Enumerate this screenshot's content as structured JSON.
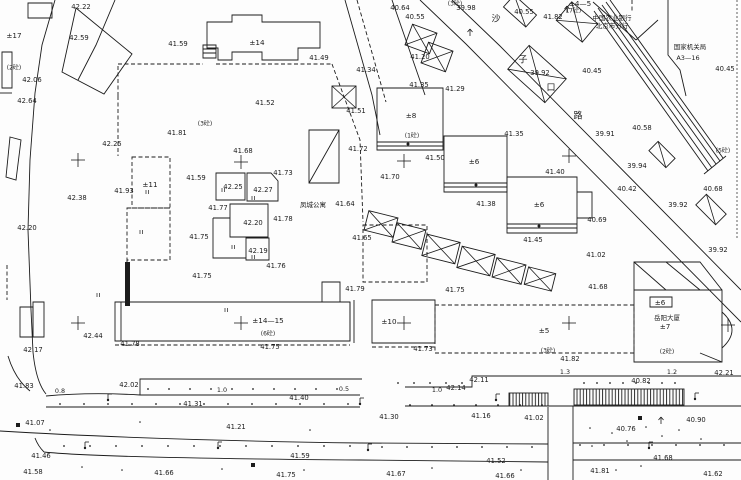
{
  "drawing": {
    "width": 741,
    "height": 480,
    "background": "#fdfdfd",
    "ink": "#1c1c1c",
    "type": "cadastral-site-plan"
  },
  "labels": {
    "elevations": [
      {
        "v": "42.22",
        "x": 81,
        "y": 7
      },
      {
        "v": "42.59",
        "x": 79,
        "y": 38
      },
      {
        "v": "42.06",
        "x": 32,
        "y": 80
      },
      {
        "v": "42.64",
        "x": 27,
        "y": 101
      },
      {
        "v": "41.59",
        "x": 178,
        "y": 44
      },
      {
        "v": "40.64",
        "x": 400,
        "y": 8
      },
      {
        "v": "40.55",
        "x": 415,
        "y": 17
      },
      {
        "v": "39.98",
        "x": 466,
        "y": 8
      },
      {
        "v": "40.55",
        "x": 524,
        "y": 12
      },
      {
        "v": "41.82",
        "x": 553,
        "y": 17
      },
      {
        "v": "39.92",
        "x": 540,
        "y": 73
      },
      {
        "v": "40.45",
        "x": 592,
        "y": 71,
        "fs": 8.5
      },
      {
        "v": "40.45",
        "x": 725,
        "y": 69
      },
      {
        "v": "41.49",
        "x": 319,
        "y": 58,
        "fs": 7.5
      },
      {
        "v": "41.34",
        "x": 366,
        "y": 70
      },
      {
        "v": "41.52",
        "x": 265,
        "y": 103
      },
      {
        "v": "41.51",
        "x": 356,
        "y": 111
      },
      {
        "v": "41.20",
        "x": 420,
        "y": 57
      },
      {
        "v": "41.35",
        "x": 419,
        "y": 85
      },
      {
        "v": "41.29",
        "x": 455,
        "y": 89
      },
      {
        "v": "40.58",
        "x": 642,
        "y": 128,
        "fs": 8
      },
      {
        "v": "39.91",
        "x": 605,
        "y": 134
      },
      {
        "v": "39.94",
        "x": 637,
        "y": 166,
        "fs": 7.5
      },
      {
        "v": "40.42",
        "x": 627,
        "y": 189,
        "fs": 7.5
      },
      {
        "v": "40.68",
        "x": 713,
        "y": 189,
        "fs": 8
      },
      {
        "v": "39.92",
        "x": 678,
        "y": 205
      },
      {
        "v": "39.92",
        "x": 718,
        "y": 250
      },
      {
        "v": "40.69",
        "x": 597,
        "y": 220
      },
      {
        "v": "42.25",
        "x": 112,
        "y": 144
      },
      {
        "v": "41.81",
        "x": 177,
        "y": 133
      },
      {
        "v": "42.38",
        "x": 77,
        "y": 198,
        "fs": 8
      },
      {
        "v": "41.93",
        "x": 124,
        "y": 191
      },
      {
        "v": "42.20",
        "x": 27,
        "y": 228
      },
      {
        "v": "41.59",
        "x": 196,
        "y": 178
      },
      {
        "v": "41.68",
        "x": 243,
        "y": 151
      },
      {
        "v": "41.73",
        "x": 283,
        "y": 173
      },
      {
        "v": "42.25",
        "x": 233,
        "y": 187
      },
      {
        "v": "42.27",
        "x": 263,
        "y": 190
      },
      {
        "v": "41.77",
        "x": 218,
        "y": 208
      },
      {
        "v": "42.20",
        "x": 253,
        "y": 223
      },
      {
        "v": "41.78",
        "x": 283,
        "y": 219
      },
      {
        "v": "41.75",
        "x": 199,
        "y": 237
      },
      {
        "v": "42.19",
        "x": 258,
        "y": 251
      },
      {
        "v": "41.76",
        "x": 276,
        "y": 266
      },
      {
        "v": "41.75",
        "x": 202,
        "y": 276
      },
      {
        "v": "41.72",
        "x": 358,
        "y": 149
      },
      {
        "v": "41.64",
        "x": 345,
        "y": 204
      },
      {
        "v": "41.65",
        "x": 362,
        "y": 238
      },
      {
        "v": "41.70",
        "x": 390,
        "y": 177
      },
      {
        "v": "41.50",
        "x": 435,
        "y": 158
      },
      {
        "v": "41.35",
        "x": 514,
        "y": 134
      },
      {
        "v": "41.40",
        "x": 555,
        "y": 172
      },
      {
        "v": "41.38",
        "x": 486,
        "y": 204
      },
      {
        "v": "41.45",
        "x": 533,
        "y": 240
      },
      {
        "v": "41.02",
        "x": 596,
        "y": 255
      },
      {
        "v": "41.68",
        "x": 598,
        "y": 287
      },
      {
        "v": "41.79",
        "x": 355,
        "y": 289
      },
      {
        "v": "41.75",
        "x": 455,
        "y": 290
      },
      {
        "v": "41.75",
        "x": 270,
        "y": 347
      },
      {
        "v": "41.73",
        "x": 423,
        "y": 349
      },
      {
        "v": "42.44",
        "x": 93,
        "y": 336
      },
      {
        "v": "42.17",
        "x": 33,
        "y": 350
      },
      {
        "v": "41.78",
        "x": 130,
        "y": 344
      },
      {
        "v": "41.82",
        "x": 570,
        "y": 359
      },
      {
        "v": "42.21",
        "x": 724,
        "y": 373
      },
      {
        "v": "41.83",
        "x": 24,
        "y": 386
      },
      {
        "v": "42.02",
        "x": 129,
        "y": 385
      },
      {
        "v": "41.31",
        "x": 193,
        "y": 404
      },
      {
        "v": "41.07",
        "x": 35,
        "y": 423
      },
      {
        "v": "41.21",
        "x": 236,
        "y": 427
      },
      {
        "v": "41.40",
        "x": 299,
        "y": 398
      },
      {
        "v": "42.14",
        "x": 456,
        "y": 388
      },
      {
        "v": "42.11",
        "x": 479,
        "y": 380
      },
      {
        "v": "41.30",
        "x": 389,
        "y": 417
      },
      {
        "v": "41.16",
        "x": 481,
        "y": 416
      },
      {
        "v": "40.82",
        "x": 641,
        "y": 381
      },
      {
        "v": "41.02",
        "x": 534,
        "y": 418
      },
      {
        "v": "40.90",
        "x": 696,
        "y": 420
      },
      {
        "v": "40.76",
        "x": 626,
        "y": 429
      },
      {
        "v": "41.46",
        "x": 41,
        "y": 456
      },
      {
        "v": "41.58",
        "x": 33,
        "y": 472
      },
      {
        "v": "41.59",
        "x": 300,
        "y": 456
      },
      {
        "v": "41.66",
        "x": 164,
        "y": 473
      },
      {
        "v": "41.75",
        "x": 286,
        "y": 475
      },
      {
        "v": "41.67",
        "x": 396,
        "y": 474
      },
      {
        "v": "41.52",
        "x": 496,
        "y": 461
      },
      {
        "v": "41.66",
        "x": 505,
        "y": 476
      },
      {
        "v": "41.68",
        "x": 663,
        "y": 458
      },
      {
        "v": "41.81",
        "x": 600,
        "y": 471
      },
      {
        "v": "41.62",
        "x": 713,
        "y": 474
      }
    ],
    "dimensions": [
      {
        "v": "0.8",
        "x": 60,
        "y": 391
      },
      {
        "v": "1.0",
        "x": 222,
        "y": 390
      },
      {
        "v": "0.5",
        "x": 344,
        "y": 389
      },
      {
        "v": "1.0",
        "x": 437,
        "y": 390
      },
      {
        "v": "1.3",
        "x": 565,
        "y": 372
      },
      {
        "v": "1.2",
        "x": 672,
        "y": 372
      }
    ],
    "buildings": [
      {
        "v": "±17",
        "x": 14,
        "y": 36
      },
      {
        "v": "±14",
        "x": 257,
        "y": 43
      },
      {
        "v": "±11",
        "x": 150,
        "y": 185
      },
      {
        "v": "±8",
        "x": 411,
        "y": 116
      },
      {
        "v": "±6",
        "x": 474,
        "y": 162
      },
      {
        "v": "±6",
        "x": 539,
        "y": 205
      },
      {
        "v": "±14—15",
        "x": 268,
        "y": 321
      },
      {
        "v": "±10",
        "x": 389,
        "y": 322
      },
      {
        "v": "±5",
        "x": 544,
        "y": 331
      },
      {
        "v": "±6",
        "x": 660,
        "y": 303
      },
      {
        "v": "±7",
        "x": 665,
        "y": 327
      },
      {
        "v": "±4—5",
        "x": 580,
        "y": 4
      }
    ],
    "materials": [
      {
        "v": "(2砼)",
        "x": 14,
        "y": 68
      },
      {
        "v": "(3砼)",
        "x": 205,
        "y": 124
      },
      {
        "v": "(3砼)",
        "x": 455,
        "y": 4
      },
      {
        "v": "(7砼)",
        "x": 574,
        "y": 11
      },
      {
        "v": "(1砼)",
        "x": 412,
        "y": 136
      },
      {
        "v": "(5砼)",
        "x": 723,
        "y": 151
      },
      {
        "v": "(6砼)",
        "x": 268,
        "y": 334
      },
      {
        "v": "(3砼)",
        "x": 548,
        "y": 351
      },
      {
        "v": "(2砼)",
        "x": 667,
        "y": 352
      }
    ],
    "names": [
      {
        "v": "凤城公寓",
        "x": 313,
        "y": 205
      },
      {
        "v": "中国农业银行",
        "x": 612,
        "y": 18
      },
      {
        "v": "北京市分行",
        "x": 612,
        "y": 26
      },
      {
        "v": "国家机关局",
        "x": 690,
        "y": 47
      },
      {
        "v": "A3—16",
        "x": 688,
        "y": 58
      },
      {
        "v": "岳阳大厦",
        "x": 667,
        "y": 318
      }
    ],
    "street": {
      "chars": [
        "沙",
        "子",
        "口",
        "路"
      ],
      "pos": [
        [
          496,
          19
        ],
        [
          523,
          60
        ],
        [
          551,
          88
        ],
        [
          578,
          116
        ]
      ]
    }
  },
  "geometry": {
    "paths": [
      {
        "d": "M28,3 H52 V18 H28 Z",
        "s": "solid"
      },
      {
        "d": "M55,0 L42,45 L35,93 L30,160 L28,230 L31,310 L33,352",
        "s": "solid"
      },
      {
        "d": "M33,352 Q36,382 46,394",
        "s": "solid"
      },
      {
        "d": "M8,356 Q15,379 30,391",
        "s": "solid"
      },
      {
        "d": "M76,8 L132,54 L104,94 L62,72 Z",
        "s": "solid"
      },
      {
        "d": "M115,0 L96,45 L78,80",
        "s": "solid"
      },
      {
        "d": "M2,52 H12 V88 H2 Z",
        "s": "solid"
      },
      {
        "d": "M10,137 L21,140 L16,180 L6,177 Z",
        "s": "solid"
      },
      {
        "d": "M20,307 H33 V337 H20 Z",
        "s": "solid"
      },
      {
        "d": "M33,302 H44 V337 H33 Z",
        "s": "solid"
      },
      {
        "d": "M207,48 V22 H232 V15 H262 V22 H320 V48 H298 V60 H262 V52 H232 V60 H218 V48 Z",
        "s": "solid"
      },
      {
        "d": "M203,45 H216 V58 H203 Z M203,49 H216 M203,53 H216",
        "s": "solid"
      },
      {
        "d": "M309,130 H339 V183 H309 Z M309,183 L339,130",
        "s": "solid"
      },
      {
        "d": "M216,173 H245 V200 H216 Z",
        "s": "solid"
      },
      {
        "d": "M247,173 H271 L278,181 V201 H247 Z",
        "s": "solid"
      },
      {
        "d": "M230,204 H268 V237 H230 Z",
        "s": "solid"
      },
      {
        "d": "M246,238 H269 V260 H246 Z",
        "s": "solid"
      },
      {
        "d": "M213,218 V258 H246 M213,218 H230",
        "s": "solid"
      },
      {
        "d": "M377,88 H443 V150 H377 Z M377,142 H443 M377,146 H443",
        "s": "solid"
      },
      {
        "d": "M444,136 H507 V192 H444 Z M444,183 H507 M444,187 H507",
        "s": "solid"
      },
      {
        "d": "M507,177 H577 V233 H507 Z M507,224 H577 M507,228 H577 M577,192 H592 V218 H577",
        "s": "solid"
      },
      {
        "d": "M115,302 H350 V341 H115 Z M322,302 V282 H340 V302 M121,302 V341",
        "s": "solid"
      },
      {
        "d": "M350,302 V341 M354,300 V343",
        "s": "solid"
      },
      {
        "d": "M372,300 H435 V343 H372 Z",
        "s": "solid"
      },
      {
        "d": "M634,290 H722 V362 H634 Z M634,290 V262 H700 L722,290 M634,262 L666,290 M666,262 L700,290 M722,312 Q742,330 722,348 M700,353 L722,362 M650,297 H672 V307 H650 Z",
        "s": "solid"
      },
      {
        "d": "M420,0 L466,44 L741,322",
        "s": "solid"
      },
      {
        "d": "M452,0 L500,46 L741,290",
        "s": "solid"
      },
      {
        "d": "M598,8 L712,168 M602,5 L716,164 M606,2 L720,161 M610,0 L723,158 M594,11 L708,171 M704,174 L726,156",
        "s": "solid"
      },
      {
        "d": "M668,0 V55 L680,70 L686,96",
        "s": "solid"
      },
      {
        "d": "M593,2 L636,40 M636,40 L658,20",
        "s": "solid"
      },
      {
        "d": "M345,0 L372,95 L380,135 M392,0 L425,95",
        "s": "solid"
      },
      {
        "d": "M357,0 L386,102",
        "s": "dash"
      },
      {
        "d": "M46,396 Q90,392 140,395 M140,395 V379 H362 M140,395 H360",
        "s": "solid"
      },
      {
        "d": "M405,387 H472 V376 H741",
        "s": "solid"
      },
      {
        "d": "M46,407 H360 M405,406 H741",
        "s": "solid"
      },
      {
        "d": "M0,431 Q150,440 360,443 L548,444 M573,443 H741",
        "s": "solid"
      },
      {
        "d": "M44,452 Q100,458 360,460 L548,462 M573,460 H741 M44,452 Q38,446 35,438",
        "s": "solid"
      },
      {
        "d": "M548,407 V480 M573,406 V480",
        "s": "solid"
      },
      {
        "d": "M737,0 V238",
        "s": "dashfine"
      },
      {
        "d": "M7,265 V300",
        "s": "dash"
      },
      {
        "d": "M118,96 V64 M118,64 H203 M216,64 H332",
        "s": "dash"
      },
      {
        "d": "M332,64 L360,140 L363,222",
        "s": "dash"
      },
      {
        "d": "M363,225 H427 V282 H363 Z",
        "s": "dash"
      },
      {
        "d": "M118,96 V156",
        "s": "dash"
      },
      {
        "d": "M132,157 H170 V208 H132 Z",
        "s": "dash"
      },
      {
        "d": "M127,208 H170 V260 H127 Z",
        "s": "dash"
      },
      {
        "d": "M127,260 V302",
        "s": "dash"
      },
      {
        "d": "M115,345 H350 M372,347 H435",
        "s": "dash"
      },
      {
        "d": "M435,305 H634 V353 H435 Z",
        "s": "dash"
      },
      {
        "d": "M632,0 V12",
        "s": "dash"
      },
      {
        "d": "M0,93 L12,93",
        "s": "solid"
      }
    ],
    "crosses": [
      [
        78,
        160
      ],
      [
        241,
        162
      ],
      [
        404,
        161
      ],
      [
        569,
        156
      ],
      [
        78,
        323
      ],
      [
        241,
        323
      ],
      [
        404,
        323
      ],
      [
        569,
        323
      ],
      [
        728,
        325
      ]
    ],
    "crossed_boxes": [
      {
        "x": 408,
        "y": 28,
        "w": 26,
        "h": 22,
        "a": 20,
        "dg": 2
      },
      {
        "x": 424,
        "y": 46,
        "w": 26,
        "h": 22,
        "a": 20,
        "dg": 2
      },
      {
        "x": 332,
        "y": 86,
        "w": 24,
        "h": 22,
        "a": 0,
        "dg": 2
      },
      {
        "x": 366,
        "y": 214,
        "w": 30,
        "h": 20,
        "a": 14,
        "dg": 2
      },
      {
        "x": 394,
        "y": 226,
        "w": 30,
        "h": 20,
        "a": 14,
        "dg": 2
      },
      {
        "x": 424,
        "y": 238,
        "w": 34,
        "h": 22,
        "a": 14,
        "dg": 2
      },
      {
        "x": 459,
        "y": 250,
        "w": 34,
        "h": 22,
        "a": 14,
        "dg": 2
      },
      {
        "x": 494,
        "y": 261,
        "w": 30,
        "h": 20,
        "a": 14,
        "dg": 2
      },
      {
        "x": 526,
        "y": 270,
        "w": 28,
        "h": 18,
        "a": 14,
        "dg": 2
      },
      {
        "x": 512,
        "y": 58,
        "w": 50,
        "h": 32,
        "a": 42,
        "dg": 2
      },
      {
        "x": 560,
        "y": 10,
        "w": 34,
        "h": 24,
        "a": 40,
        "dg": 2
      },
      {
        "x": 505,
        "y": 3,
        "w": 30,
        "h": 16,
        "a": 42,
        "dg": 1
      },
      {
        "x": 650,
        "y": 148,
        "w": 24,
        "h": 13,
        "a": 45,
        "dg": 1
      },
      {
        "x": 697,
        "y": 202,
        "w": 28,
        "h": 15,
        "a": 45,
        "dg": 1
      }
    ],
    "hatch_rects": [
      {
        "x": 509,
        "y": 393,
        "w": 39,
        "h": 13
      },
      {
        "x": 574,
        "y": 389,
        "w": 110,
        "h": 16
      }
    ],
    "bars": [
      {
        "x": 125,
        "y": 262,
        "w": 5,
        "h": 44
      }
    ],
    "footer_dots": [
      [
        408,
        144
      ],
      [
        476,
        185
      ],
      [
        539,
        226
      ]
    ],
    "lamps": [
      [
        108,
        400
      ],
      [
        360,
        404
      ],
      [
        496,
        400
      ],
      [
        695,
        399
      ],
      [
        85,
        448
      ],
      [
        218,
        448
      ],
      [
        368,
        450
      ],
      [
        649,
        448
      ]
    ],
    "squares": [
      [
        18,
        425
      ],
      [
        253,
        465
      ],
      [
        640,
        418
      ]
    ],
    "trees": [
      [
        567,
        10
      ],
      [
        470,
        33
      ],
      [
        661,
        421
      ]
    ],
    "dot_rows": [
      {
        "y": 389,
        "x1": 148,
        "x2": 356,
        "st": 21
      },
      {
        "y": 383,
        "x1": 398,
        "x2": 466,
        "st": 16
      },
      {
        "y": 383,
        "x1": 584,
        "x2": 676,
        "st": 13
      },
      {
        "y": 404,
        "x1": 60,
        "x2": 356,
        "st": 24
      },
      {
        "y": 405,
        "x1": 410,
        "x2": 543,
        "st": 22
      },
      {
        "y": 446,
        "x1": 64,
        "x2": 366,
        "st": 26
      },
      {
        "y": 447,
        "x1": 382,
        "x2": 543,
        "st": 25
      },
      {
        "y": 445,
        "x1": 580,
        "x2": 735,
        "st": 24
      }
    ],
    "scatter_dots": [
      [
        590,
        428
      ],
      [
        612,
        433
      ],
      [
        627,
        441
      ],
      [
        646,
        427
      ],
      [
        662,
        436
      ],
      [
        679,
        430
      ],
      [
        701,
        439
      ],
      [
        592,
        446
      ],
      [
        616,
        470
      ],
      [
        641,
        466
      ],
      [
        304,
        470
      ],
      [
        222,
        469
      ],
      [
        521,
        470
      ],
      [
        432,
        468
      ],
      [
        122,
        470
      ],
      [
        82,
        467
      ],
      [
        50,
        430
      ],
      [
        140,
        422
      ],
      [
        310,
        430
      ]
    ],
    "ticks": [
      [
        222,
        190
      ],
      [
        252,
        198
      ],
      [
        232,
        247
      ],
      [
        252,
        257
      ],
      [
        140,
        232
      ],
      [
        146,
        192
      ],
      [
        97,
        295
      ],
      [
        225,
        310
      ]
    ]
  }
}
